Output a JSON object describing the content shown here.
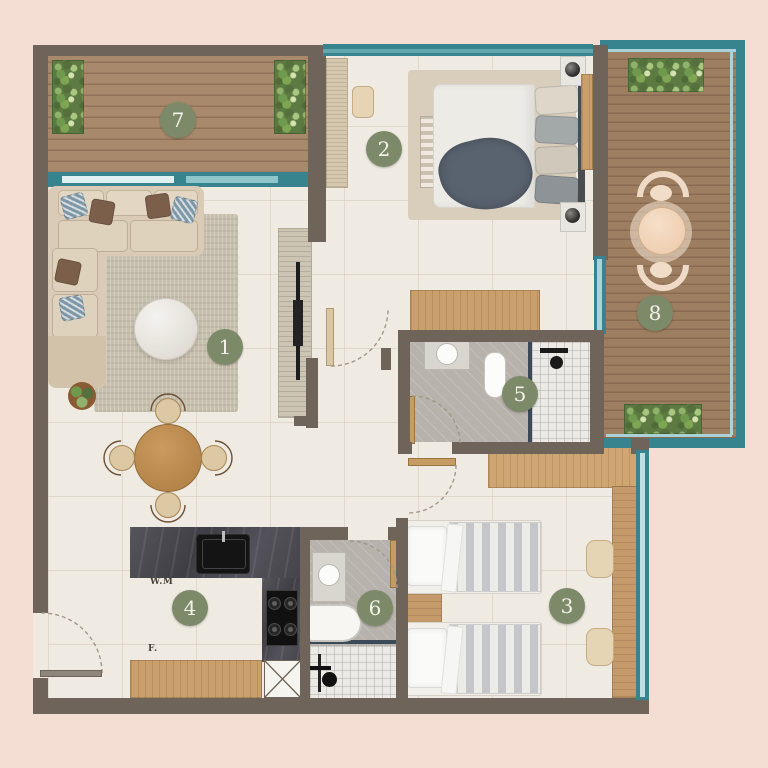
{
  "plan": {
    "badges": [
      {
        "number": "1"
      },
      {
        "number": "2"
      },
      {
        "number": "3"
      },
      {
        "number": "4"
      },
      {
        "number": "5"
      },
      {
        "number": "6"
      },
      {
        "number": "7"
      },
      {
        "number": "8"
      }
    ],
    "kitchen": {
      "washing_machine_label": "W.M",
      "fridge_label": "F."
    },
    "colors": {
      "background": "#f4ddd2",
      "wall": "#6f6459",
      "glass": "#37838e",
      "glass_light": "#a9d3d6",
      "deck_wood": "#a9896b",
      "cabinet_wood": "#c49a6a",
      "floor": "#f0ebe2",
      "badge": "#7c8a69",
      "counter": "#47464b",
      "greenery": "#5c7a42"
    }
  }
}
